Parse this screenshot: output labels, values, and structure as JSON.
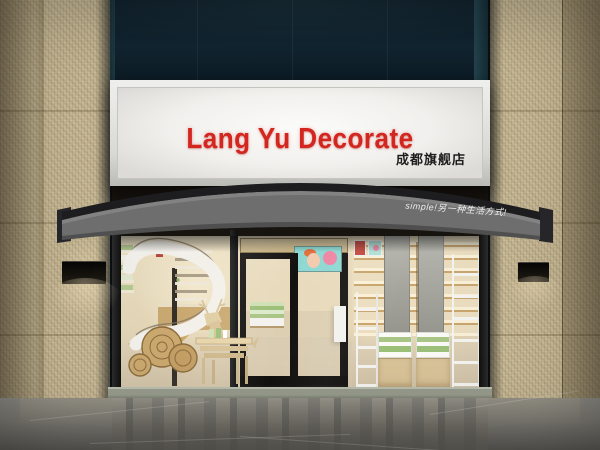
{
  "sign": {
    "title": "Lang Yu Decorate",
    "subtitle": "成都旗舰店",
    "title_color": "#d3261f",
    "subtitle_color": "#1d1d1d",
    "panel_color": "#f2f1ee"
  },
  "awning": {
    "slogan": "simple!另一种生活方式!",
    "fabric_color": "#6e6e6e",
    "top_band_color": "#1d1d1f"
  },
  "colors": {
    "granite_beige": "#c6b794",
    "upper_wall_navy": "#10212c",
    "storefront_frame_black": "#1a1a1a",
    "interior_warm_beige": "#e9dbbd",
    "wood_tan": "#c9a86f",
    "product_green": "#a9c585",
    "pavement_gray": "#7b7972",
    "threshold_stone": "#969b8c"
  }
}
